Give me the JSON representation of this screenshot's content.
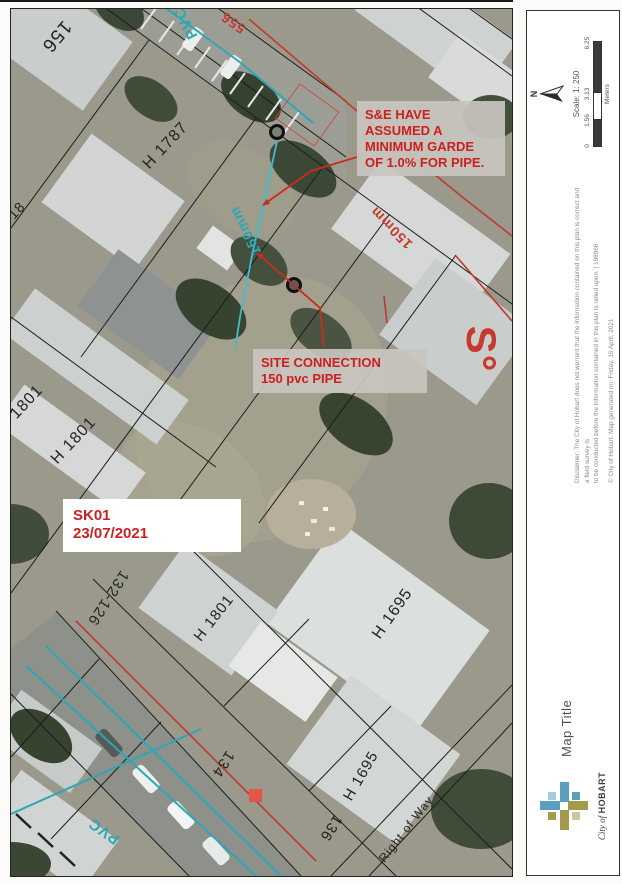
{
  "map": {
    "labels": [
      "156",
      "556",
      "PVC",
      "150mm",
      "H 1787",
      "H 18",
      "H 1801",
      "H 1801",
      "H 1801",
      "H 1695",
      "H 1695",
      "132-126",
      "134",
      "136",
      "Right of Way",
      "PVC",
      "150mm",
      "S°"
    ],
    "notes": {
      "sae": [
        "S&E HAVE",
        "ASSUMED A",
        "MINIMUM GARDE",
        "OF 1.0% FOR PIPE."
      ],
      "site": [
        "SITE CONNECTION",
        "150 pvc PIPE"
      ],
      "sk": [
        "SK01",
        "23/07/2021"
      ]
    }
  },
  "panel": {
    "north": "N",
    "scale_text": "Scale: 1: 250",
    "ticks": [
      "0",
      "1.56",
      "3.13",
      "6.25"
    ],
    "units": "Meters",
    "disclaimer1": "Disclaimer: The City of Hobart does not warrant that the information contained on this plan is correct and a field survey is",
    "disclaimer2": "to be conducted before the information contained in this plan is relied upon. | 198968",
    "copyright": "© City of Hobart. Map generated on: Friday, 16 April, 2021",
    "title": "Map Title",
    "brand_city": "City of",
    "brand_name": "HOBART"
  },
  "colors": {
    "annotation_red": "#cc1f1f",
    "utility_teal": "#2aa7b8",
    "connection_cyan": "#41bcd1",
    "sewer_red": "#c0392e",
    "logo_olive": "#a39a4e",
    "logo_blue": "#5b9fc0"
  }
}
